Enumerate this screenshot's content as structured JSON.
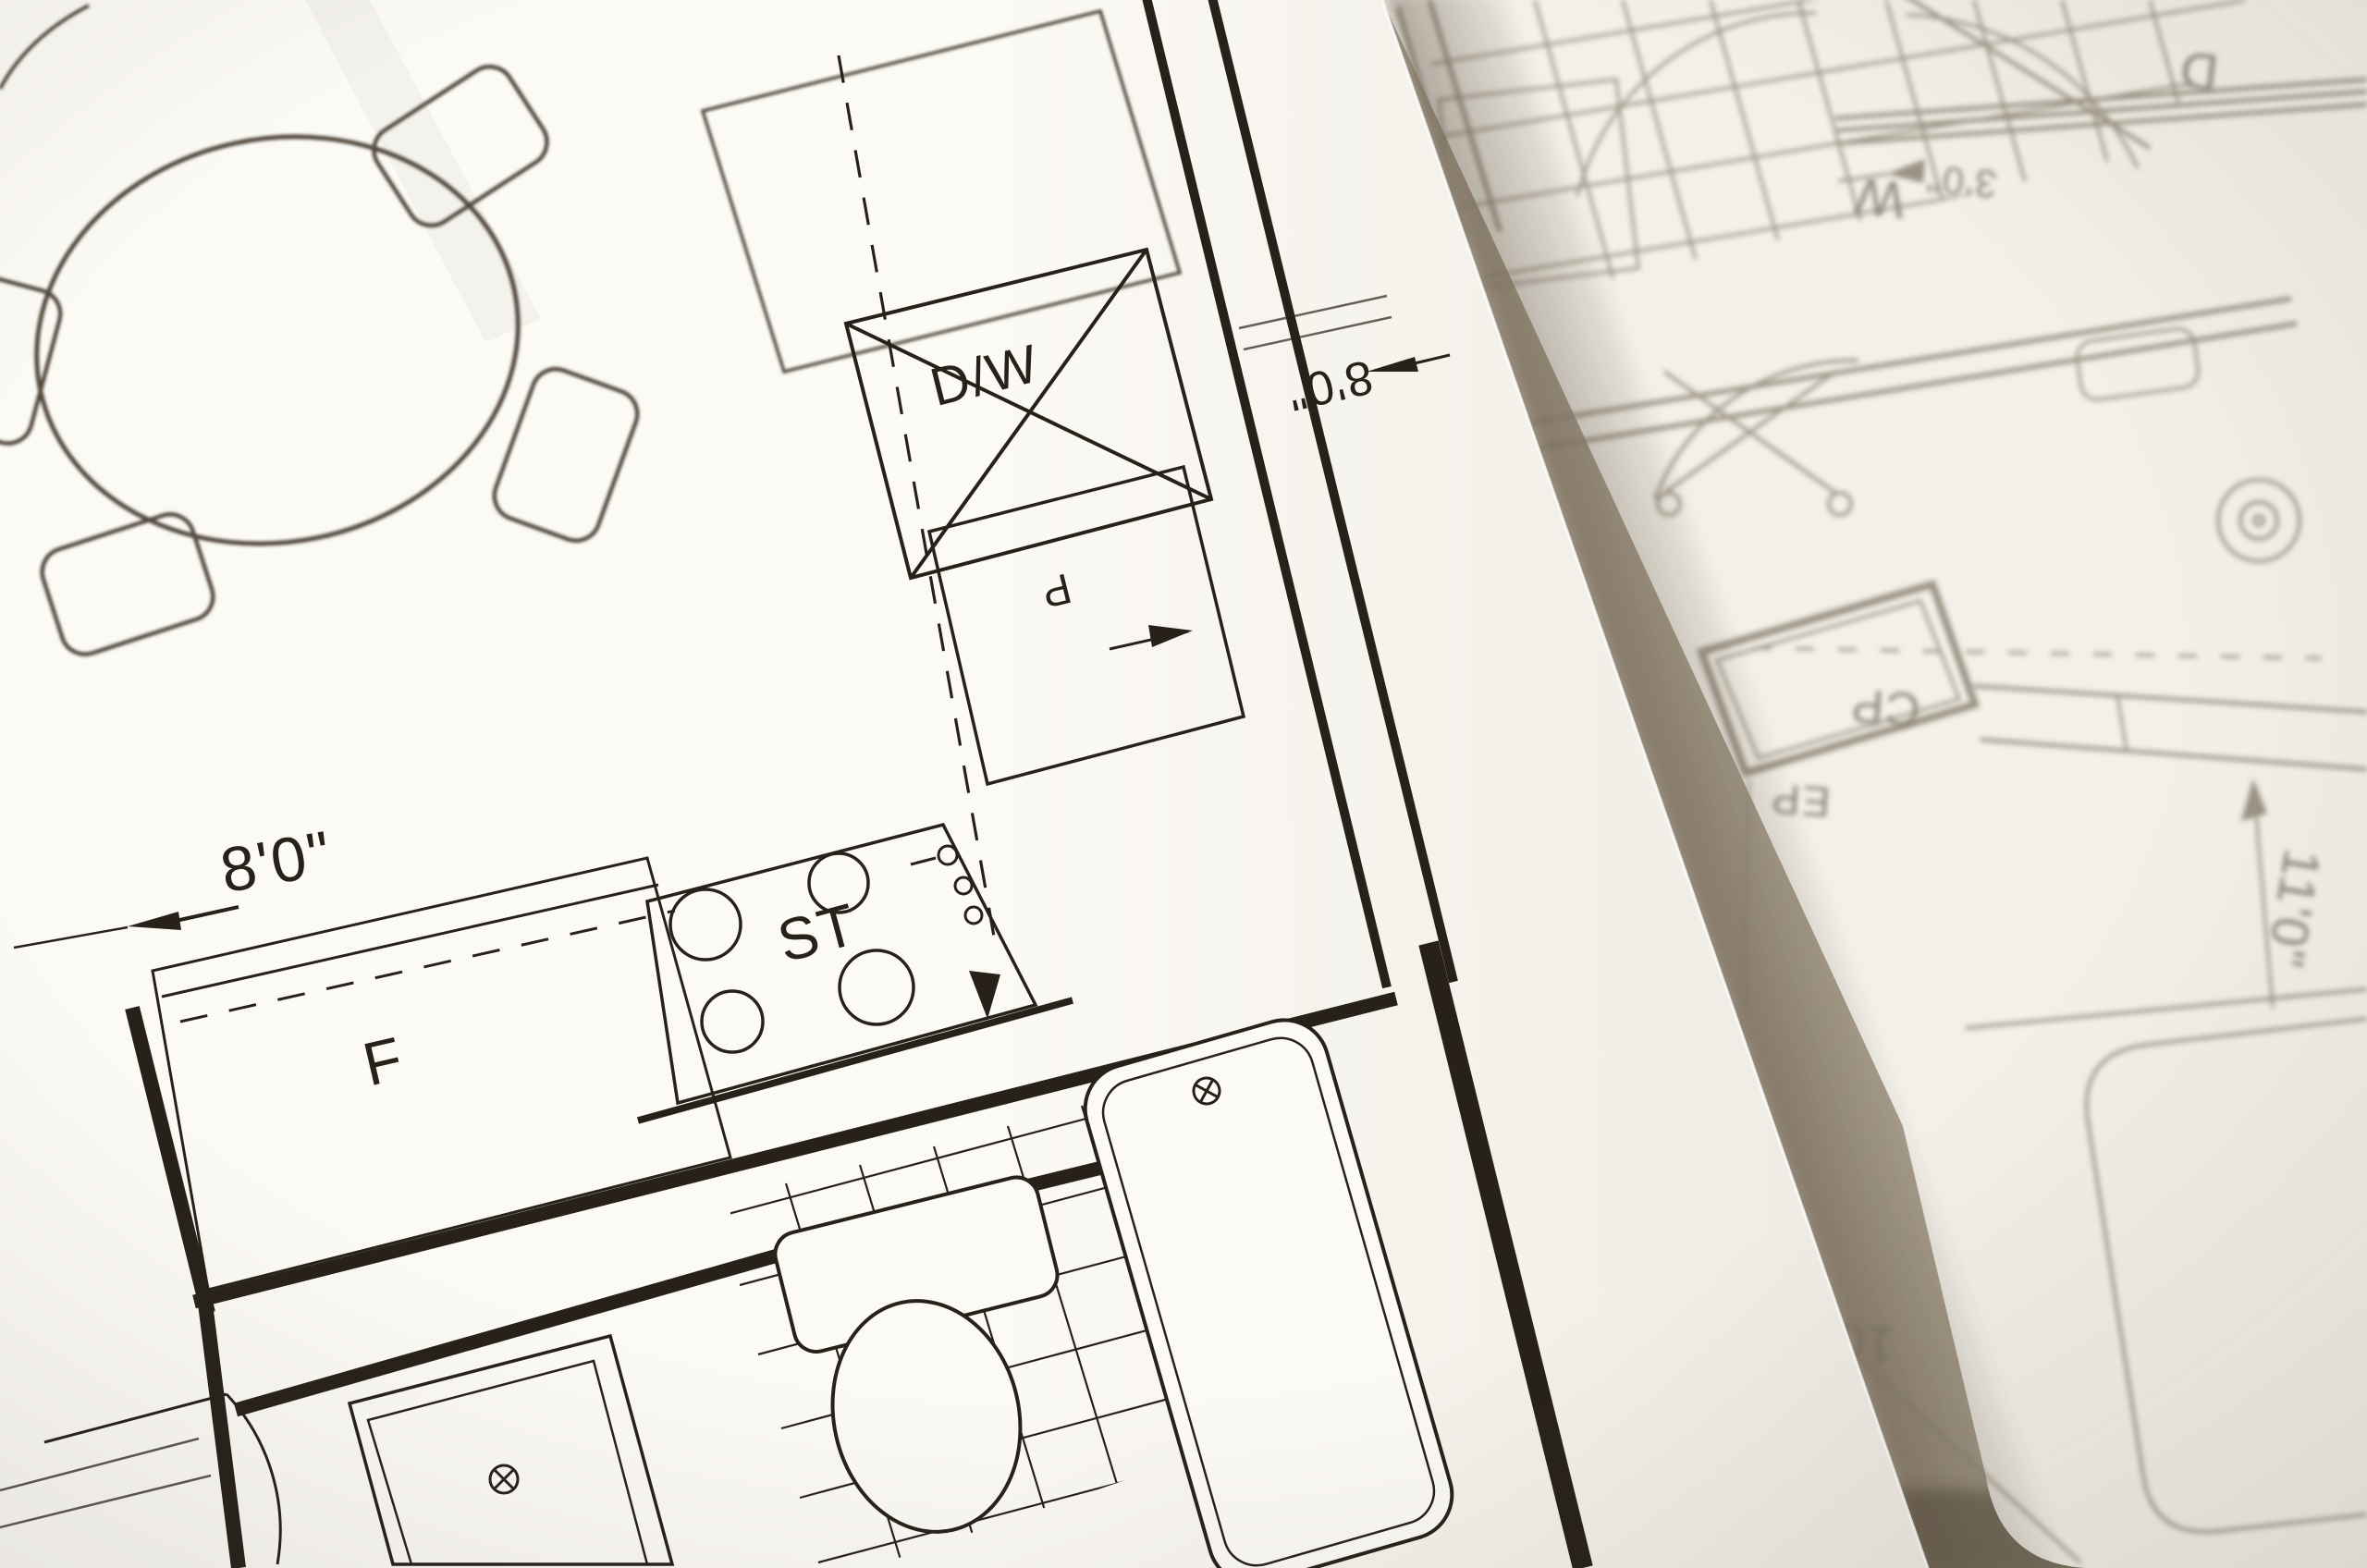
{
  "photo": {
    "left_sheet_labels": {
      "dishwasher": "D/W",
      "stove": "ST",
      "refrigerator": "F",
      "pantry": "P",
      "dim_counter": "8'0\"",
      "dim_kitchen": "8'0\""
    },
    "right_sheet_labels": {
      "washer": "W",
      "dryer": "D",
      "closet": "CP",
      "electrical_panel": "EP",
      "dim_room_height": "11'0\"",
      "dim_room_width": "10'0\"",
      "dim_closet": "3'0\""
    },
    "colors": {
      "ink_sharp": "#27211a",
      "ink_soft": "#52493d",
      "ink_blurred": "#968e7f",
      "paper_top_sheet": "#fcfaf5",
      "paper_under_sheet": "#f3f0e9",
      "surface_shadow": "#a89e8d"
    }
  }
}
